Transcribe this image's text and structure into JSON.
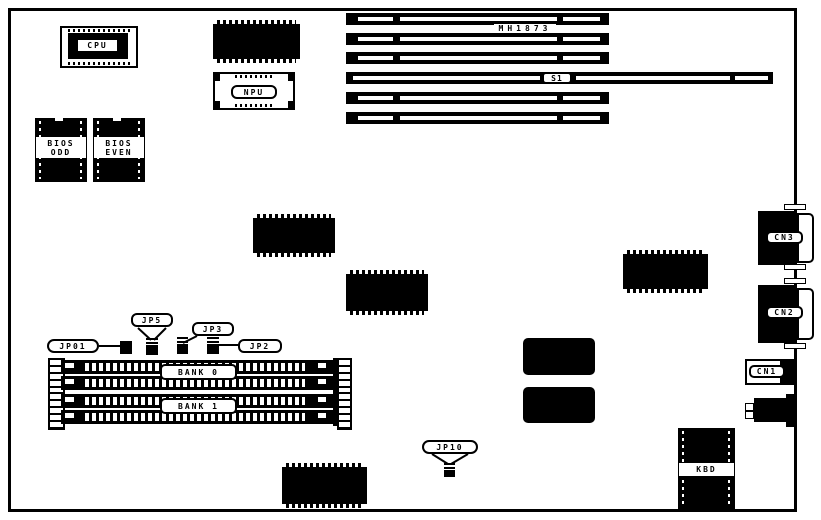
{
  "diagram": {
    "kind": "motherboard-component-layout"
  },
  "colors": {
    "ink": "#000000",
    "paper": "#ffffff"
  },
  "sockets": {
    "cpu": {
      "label": "CPU"
    },
    "npu": {
      "label": "NPU"
    },
    "bios_odd": {
      "line1": "BIOS",
      "line2": "ODD"
    },
    "bios_even": {
      "line1": "BIOS",
      "line2": "EVEN"
    }
  },
  "slots": {
    "model_label": "MH1873",
    "s1_label": "S1"
  },
  "jumpers": {
    "jp01": "JP01",
    "jp5": "JP5",
    "jp3": "JP3",
    "jp2": "JP2",
    "jp10": "JP10"
  },
  "memory": {
    "bank0": "BANK 0",
    "bank1": "BANK 1"
  },
  "connectors": {
    "cn3": "CN3",
    "cn2": "CN2",
    "cn1": "CN1",
    "kbd": "KBD"
  }
}
